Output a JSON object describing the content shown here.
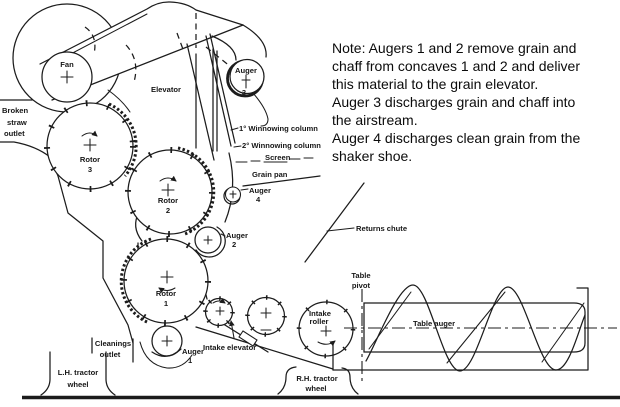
{
  "note": {
    "lines": [
      "Note: Augers 1 and 2 remove grain and",
      "chaff from concaves 1 and 2  and deliver",
      "this material to the grain elevator.",
      "Auger 3 discharges grain and chaff into",
      "the airstream.",
      "Auger 4 discharges clean grain from the",
      "shaker shoe."
    ]
  },
  "labels": {
    "fan": "Fan",
    "elevator": "Elevator",
    "auger3_name": "Auger",
    "auger3_num": "3",
    "broken_straw_1": "Broken",
    "broken_straw_2": "straw",
    "broken_straw_3": "outlet",
    "rotor3_name": "Rotor",
    "rotor3_num": "3",
    "rotor2_name": "Rotor",
    "rotor2_num": "2",
    "rotor1_name": "Rotor",
    "rotor1_num": "1",
    "auger2_name": "Auger",
    "auger2_num": "2",
    "auger4_name": "Auger",
    "auger4_num": "4",
    "auger1_name": "Auger",
    "auger1_num": "1",
    "winnowing_col_1": "1° Winnowing column",
    "winnowing_col_2": "2° Winnowing column",
    "screen": "Screen",
    "grain_pan": "Grain pan",
    "returns_chute": "Returns chute",
    "cleanings_1": "Cleanings",
    "cleanings_2": "outlet",
    "lh_wheel_1": "L.H. tractor",
    "lh_wheel_2": "wheel",
    "rh_wheel_1": "R.H. tractor",
    "rh_wheel_2": "wheel",
    "intake_elevator": "Intake elevator",
    "intake_roller_1": "Intake",
    "intake_roller_2": "roller",
    "table_pivot_1": "Table",
    "table_pivot_2": "pivot",
    "table_auger": "Table auger"
  },
  "colors": {
    "ink": "#1c1c1c",
    "paper": "#ffffff"
  }
}
